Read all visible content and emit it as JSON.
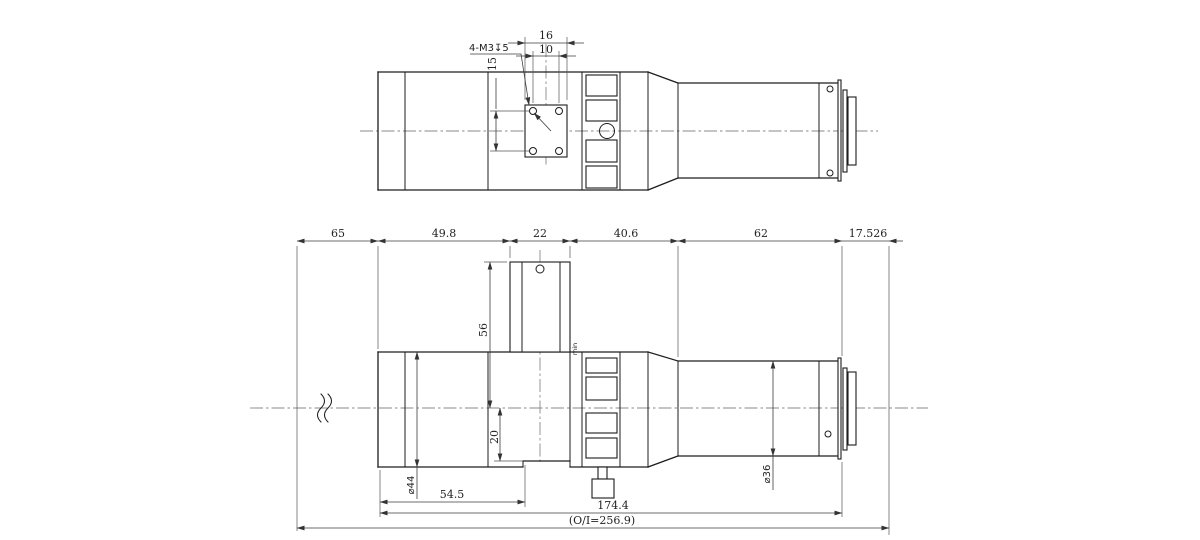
{
  "top_view": {
    "dim_16": "16",
    "dim_10": "10",
    "dim_15": "15",
    "thread_callout": "4-M3↧5"
  },
  "front_view": {
    "dim_65": "65",
    "dim_49_8": "49.8",
    "dim_22": "22",
    "dim_40_6": "40.6",
    "dim_62": "62",
    "dim_17_526": "17.526",
    "dim_56": "56",
    "dim_20": "20",
    "dia_44": "⌀44",
    "dia_36": "⌀36",
    "dim_54_5": "54.5",
    "dim_174_4": "174.4",
    "oi_distance": "(O/I=256.9)",
    "ring_label": "min"
  },
  "colors": {
    "line": "#1d1d1d",
    "dimension": "#3c3c3c",
    "centerline": "#8a8a8a",
    "background": "#ffffff"
  }
}
